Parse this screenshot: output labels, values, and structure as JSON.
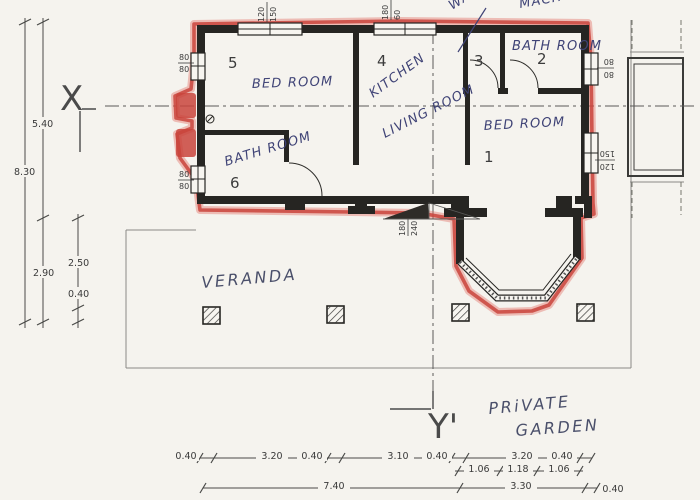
{
  "title": "Scanned house floor plan sketch with red marker outline",
  "colors": {
    "paper": "#f5f3ee",
    "ink": "#262522",
    "red_marker": "#c9443c",
    "pen_ink": "#3f4376"
  },
  "axis_markers": {
    "x": "X",
    "y": "Y'"
  },
  "rooms": {
    "r1": {
      "number": "1",
      "label": "BED ROOM"
    },
    "r2": {
      "number": "2",
      "label": "BATH ROOM"
    },
    "r3": {
      "number": "3"
    },
    "r4": {
      "number": "4",
      "label": "KITCHEN"
    },
    "r5": {
      "number": "5",
      "label": "BED ROOM"
    },
    "r6": {
      "number": "6",
      "label": "BATH ROOM"
    }
  },
  "annotations": {
    "living_room": "LIVING ROOM",
    "veranda": "VERANDA",
    "private": "PRiVATE",
    "garden": "GARDEN",
    "washer1": "WASH",
    "washer2": "MACH"
  },
  "window_labels": {
    "left_top": {
      "a": "80",
      "b": "80"
    },
    "left_bottom": {
      "a": "80",
      "b": "80"
    },
    "top_left": {
      "a": "120",
      "b": "150"
    },
    "top_mid": {
      "a": "180",
      "b": "60"
    },
    "right_top": {
      "a": "80",
      "b": "80"
    },
    "right_bottom": {
      "a": "120",
      "b": "150"
    },
    "entrance": {
      "a": "180",
      "b": "240"
    }
  },
  "left_dims": {
    "upper": "5.40",
    "total": "8.30",
    "lower": "2.90",
    "veranda": "2.50",
    "edge": "0.40"
  },
  "bottom_dims": {
    "row1": [
      "0.40",
      "3.20",
      "0.40",
      "3.10",
      "0.40",
      "3.20",
      "0.40"
    ],
    "row2": [
      "1.06",
      "1.18",
      "1.06"
    ],
    "row3": [
      "7.40",
      "3.30",
      "0.40"
    ]
  }
}
